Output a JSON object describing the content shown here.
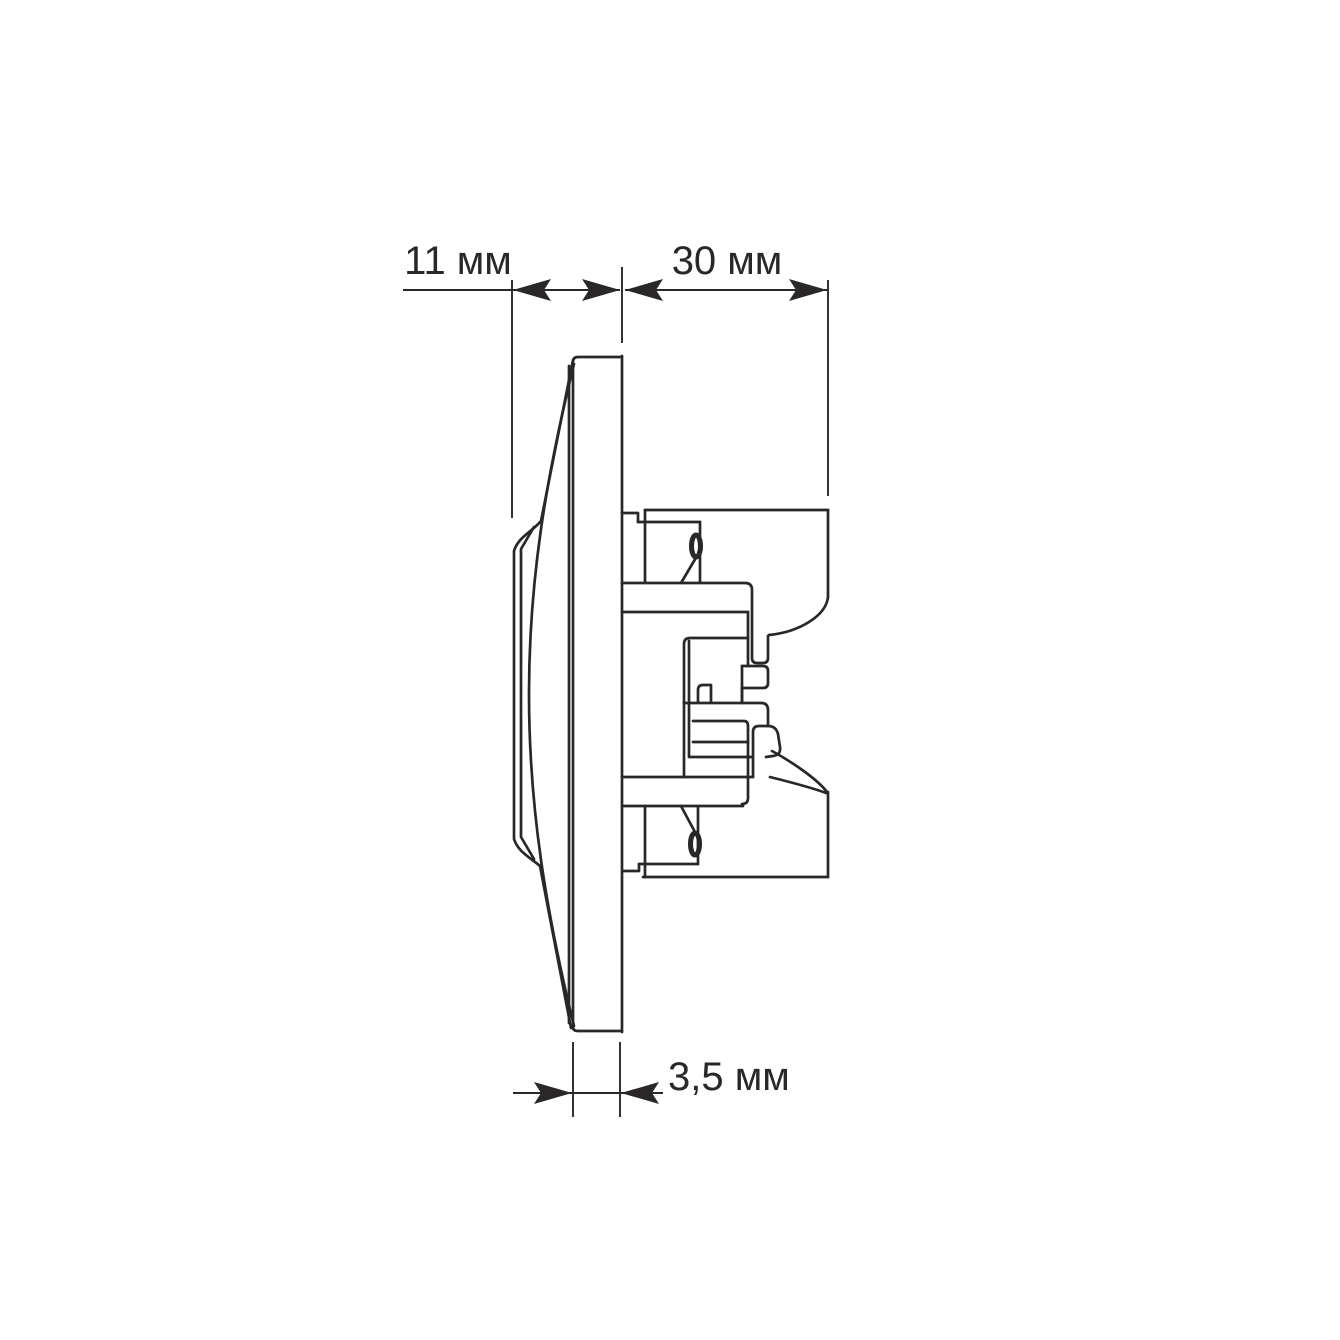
{
  "page": {
    "background_color": "#ffffff",
    "line_color": "#2a2728"
  },
  "drawing": {
    "kind": "side-profile dimension drawing",
    "unit": "мм",
    "dimensions": [
      {
        "id": "front-projection-depth",
        "label": "11 мм",
        "value": 11
      },
      {
        "id": "mounting-depth",
        "label": "30 мм",
        "value": 30
      },
      {
        "id": "plate-thickness",
        "label": "3,5 мм",
        "value": 3.5
      }
    ]
  }
}
